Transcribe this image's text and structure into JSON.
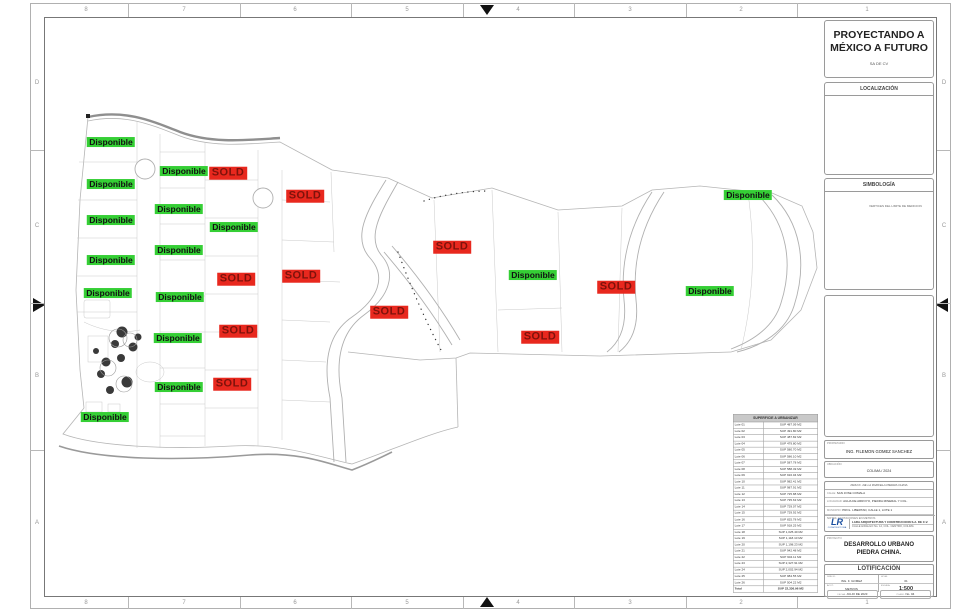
{
  "sheet": {
    "grid_columns": [
      "8",
      "7",
      "6",
      "5",
      "4",
      "3",
      "2",
      "1"
    ],
    "grid_rows": [
      "D",
      "C",
      "B",
      "A"
    ]
  },
  "company": {
    "line1": "PROYECTANDO A",
    "line2": "MÉXICO A FUTURO",
    "line3": "SA DE CV"
  },
  "localizacion": {
    "title": "LOCALIZACIÓN"
  },
  "simbologia": {
    "title": "SIMBOLOGÍA",
    "legend": "VERTICES DEL LIMITE DE MEDICION"
  },
  "owner": {
    "label": "PROPIETARIO:",
    "value": "ING. FILEMON GOMEZ SANCHEZ"
  },
  "ubicacion": {
    "label": "UBICACIÓN:",
    "value": "COLIMA / 2024"
  },
  "info": {
    "header": "FRACC. DE LA PARCELA PIEDRA CHINA",
    "rows": [
      {
        "label": "CALLE:",
        "value": "SAN JOSE COMALA"
      },
      {
        "label": "LOCALIDAD:",
        "value": "AGUA DE ARROYO, PIEDRA MINERAL Y COL."
      },
      {
        "label": "MUNICIPIO:",
        "value": "PROL. LIBERTAD, CALLE 1, LOTE 1"
      }
    ],
    "notes": "NOTAS: ACOTACIONES EN METROS",
    "logo": "LR",
    "logo_sub": "CONSTRUCTORA",
    "company_name": "LARA ARQUITECTURA Y CONSTRUCCION S.A. DE C.V.",
    "company_line2": "CALLE HIDALGO No. 12, COL. CENTRO, COLIMA"
  },
  "proyecto": {
    "label": "PROYECTO:",
    "line1": "DESARROLLO URBANO",
    "line2": "PIEDRA CHINA."
  },
  "lotificacion": {
    "title": "LOTIFICACIÓN",
    "fields": [
      {
        "label": "DIBUJO:",
        "value": "ING. F. GOMEZ"
      },
      {
        "label": "HOJA:",
        "value": "01"
      },
      {
        "label": "ACOT:",
        "value": "METROS"
      },
      {
        "label": "ESCALA:",
        "value": "1:500"
      }
    ],
    "bottom_fields": [
      {
        "label": "FECHA:",
        "value": "JULIO DE 2023"
      },
      {
        "label": "PLANO:",
        "value": "No. 04"
      }
    ]
  },
  "table": {
    "title": "SUPERFICIE A URBANIZAR",
    "rows": [
      [
        "Lote 01",
        "SUP 487.09 M2"
      ],
      [
        "Lote 02",
        "SUP 491.80 M2"
      ],
      [
        "Lote 03",
        "SUP 487.82 M2"
      ],
      [
        "Lote 04",
        "SUP 479.80 M2"
      ],
      [
        "Lote 05",
        "SUP 580.70 M2"
      ],
      [
        "Lote 06",
        "SUP 586.10 M2"
      ],
      [
        "Lote 07",
        "SUP 587.78 M2"
      ],
      [
        "Lote 08",
        "SUP 588.49 M2"
      ],
      [
        "Lote 09",
        "SUP 916.04 M2"
      ],
      [
        "Lote 10",
        "SUP 982.41 M2"
      ],
      [
        "Lote 11",
        "SUP 987.91 M2"
      ],
      [
        "Lote 12",
        "SUP 725.88 M2"
      ],
      [
        "Lote 13",
        "SUP 735.63 M2"
      ],
      [
        "Lote 14",
        "SUP 729.07 M2"
      ],
      [
        "Lote 15",
        "SUP 729.92 M2"
      ],
      [
        "Lote 16",
        "SUP 825.78 M2"
      ],
      [
        "Lote 17",
        "SUP 918.25 M2"
      ],
      [
        "Lote 18",
        "SUP 1,025.40 M2"
      ],
      [
        "Lote 19",
        "SUP 1,118.10 M2"
      ],
      [
        "Lote 20",
        "SUP 1,198.23 M2"
      ],
      [
        "Lote 21",
        "SUP 942.48 M2"
      ],
      [
        "Lote 22",
        "SUP 904.11 M2"
      ],
      [
        "Lote 23",
        "SUP 2,327.91 M2"
      ],
      [
        "Lote 24",
        "SUP 2,002.94 M2"
      ],
      [
        "Lote 25",
        "SUP 984.55 M2"
      ],
      [
        "Lote 26",
        "SUP 504.22 M2"
      ]
    ],
    "total": [
      "Total",
      "SUP 22,336.96 M2"
    ]
  },
  "labels": {
    "available": "Disponible",
    "sold": "SOLD"
  },
  "colors": {
    "available_bg": "#35cf35",
    "sold_bg": "#e8281e",
    "sold_text": "#7e120b"
  },
  "map_labels": [
    {
      "type": "available",
      "x": 111,
      "y": 142
    },
    {
      "type": "available",
      "x": 111,
      "y": 184
    },
    {
      "type": "available",
      "x": 111,
      "y": 220
    },
    {
      "type": "available",
      "x": 111,
      "y": 260
    },
    {
      "type": "available",
      "x": 108,
      "y": 293
    },
    {
      "type": "available",
      "x": 184,
      "y": 171
    },
    {
      "type": "available",
      "x": 179,
      "y": 209
    },
    {
      "type": "available",
      "x": 179,
      "y": 250
    },
    {
      "type": "available",
      "x": 180,
      "y": 297
    },
    {
      "type": "available",
      "x": 178,
      "y": 338
    },
    {
      "type": "available",
      "x": 179,
      "y": 387
    },
    {
      "type": "available",
      "x": 234,
      "y": 227
    },
    {
      "type": "available",
      "x": 105,
      "y": 417
    },
    {
      "type": "available",
      "x": 533,
      "y": 275
    },
    {
      "type": "available",
      "x": 710,
      "y": 291
    },
    {
      "type": "available",
      "x": 748,
      "y": 195
    },
    {
      "type": "sold",
      "x": 228,
      "y": 173
    },
    {
      "type": "sold",
      "x": 305,
      "y": 196
    },
    {
      "type": "sold",
      "x": 452,
      "y": 247
    },
    {
      "type": "sold",
      "x": 301,
      "y": 276
    },
    {
      "type": "sold",
      "x": 236,
      "y": 279
    },
    {
      "type": "sold",
      "x": 389,
      "y": 312
    },
    {
      "type": "sold",
      "x": 238,
      "y": 331
    },
    {
      "type": "sold",
      "x": 540,
      "y": 337
    },
    {
      "type": "sold",
      "x": 616,
      "y": 287
    },
    {
      "type": "sold",
      "x": 232,
      "y": 384
    }
  ]
}
